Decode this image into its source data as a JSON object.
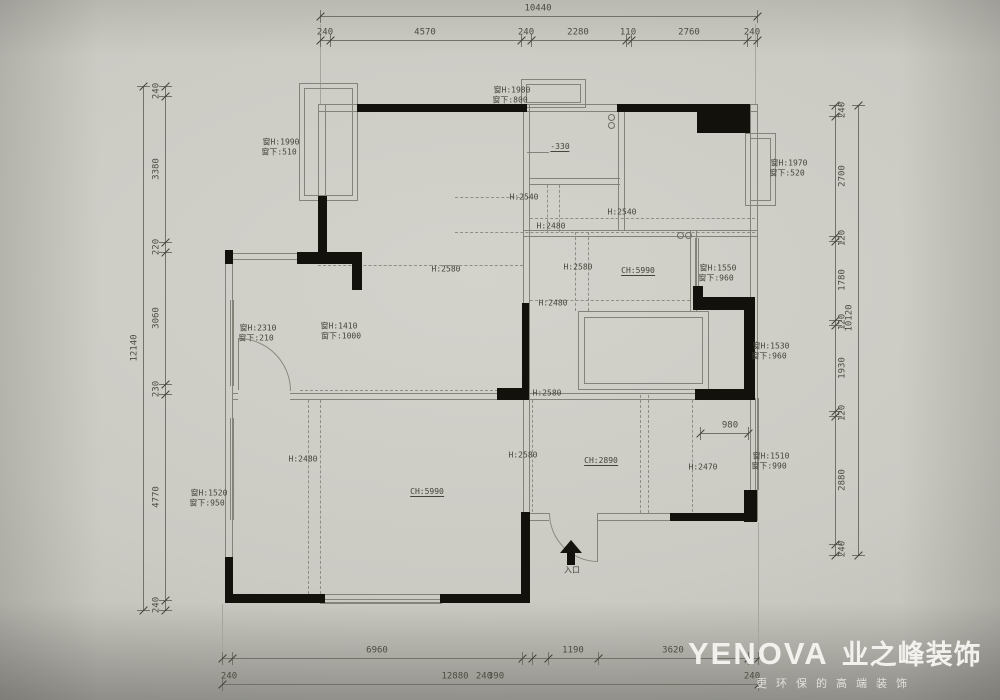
{
  "palette": {
    "background": "#cbcac3",
    "thin_line": "#84837a",
    "black_wall": "#12110c",
    "text": "#45443c",
    "logo_text": "#f2f1ed"
  },
  "dimensions": [
    {
      "id": "top-overall",
      "o": "h",
      "pos": 16,
      "a": 320,
      "b": 757,
      "ticks": [
        320,
        757
      ],
      "labels": [
        {
          "t": "10440",
          "p": 538
        }
      ]
    },
    {
      "id": "top-segments",
      "o": "h",
      "pos": 40,
      "a": 320,
      "b": 757,
      "ticks": [
        320,
        330,
        521,
        531,
        626,
        631,
        747,
        757
      ],
      "labels": [
        {
          "t": "240",
          "p": 325
        },
        {
          "t": "4570",
          "p": 425
        },
        {
          "t": "240",
          "p": 526
        },
        {
          "t": "2280",
          "p": 578
        },
        {
          "t": "110",
          "p": 628
        },
        {
          "t": "2760",
          "p": 689
        },
        {
          "t": "240",
          "p": 752
        }
      ]
    },
    {
      "id": "left-overall",
      "o": "v",
      "pos": 143,
      "a": 86,
      "b": 610,
      "lside": -1,
      "ticks": [
        86,
        610
      ],
      "labels": [
        {
          "t": "12140",
          "p": 348
        }
      ]
    },
    {
      "id": "left-segments",
      "o": "v",
      "pos": 165,
      "a": 86,
      "b": 610,
      "lside": -1,
      "ticks": [
        86,
        96,
        242,
        252,
        384,
        394,
        600,
        610
      ],
      "labels": [
        {
          "t": "240",
          "p": 91
        },
        {
          "t": "3380",
          "p": 169
        },
        {
          "t": "220",
          "p": 247
        },
        {
          "t": "3060",
          "p": 318
        },
        {
          "t": "230",
          "p": 389
        },
        {
          "t": "4770",
          "p": 497
        },
        {
          "t": "240",
          "p": 605
        }
      ]
    },
    {
      "id": "right-segments",
      "o": "v",
      "pos": 835,
      "a": 105,
      "b": 555,
      "lside": 1,
      "ticks": [
        105,
        116,
        236,
        241,
        320,
        325,
        411,
        416,
        544,
        555
      ],
      "labels": [
        {
          "t": "240",
          "p": 110
        },
        {
          "t": "2700",
          "p": 176
        },
        {
          "t": "120",
          "p": 238
        },
        {
          "t": "1780",
          "p": 280
        },
        {
          "t": "120",
          "p": 322
        },
        {
          "t": "1930",
          "p": 368
        },
        {
          "t": "120",
          "p": 413
        },
        {
          "t": "2880",
          "p": 480
        },
        {
          "t": "240",
          "p": 549
        }
      ]
    },
    {
      "id": "right-overall",
      "o": "v",
      "pos": 858,
      "a": 105,
      "b": 555,
      "lside": -1,
      "ticks": [
        105,
        555
      ],
      "labels": [
        {
          "t": "10120",
          "p": 318
        }
      ]
    },
    {
      "id": "bottom-segments",
      "o": "h",
      "pos": 658,
      "a": 222,
      "b": 758,
      "ticks": [
        222,
        232,
        522,
        532,
        548,
        598,
        748,
        758
      ],
      "labels": [
        {
          "t": "6960",
          "p": 377
        },
        {
          "t": "1190",
          "p": 573
        },
        {
          "t": "3620",
          "p": 673
        }
      ]
    },
    {
      "id": "bottom-overall",
      "o": "h",
      "pos": 684,
      "a": 222,
      "b": 758,
      "ticks": [
        222,
        758
      ],
      "labels": [
        {
          "t": "240",
          "p": 229
        },
        {
          "t": "12880",
          "p": 455
        },
        {
          "t": "240",
          "p": 484
        },
        {
          "t": "390",
          "p": 496
        },
        {
          "t": "240",
          "p": 752
        }
      ]
    },
    {
      "id": "dim-980",
      "o": "h",
      "pos": 433,
      "a": 700,
      "b": 748,
      "ticks": [
        700,
        748
      ],
      "labels": [
        {
          "t": "980",
          "p": 730
        }
      ]
    }
  ],
  "annotations": [
    {
      "t": "窗H:1980",
      "x": 512,
      "y": 90
    },
    {
      "t": "窗下:800",
      "x": 510,
      "y": 100
    },
    {
      "t": "窗H:1990",
      "x": 281,
      "y": 142
    },
    {
      "t": "窗下:510",
      "x": 279,
      "y": 152
    },
    {
      "t": "窗H:1970",
      "x": 789,
      "y": 163
    },
    {
      "t": "窗下:520",
      "x": 787,
      "y": 173
    },
    {
      "t": "-330",
      "x": 560,
      "y": 147,
      "ul": true
    },
    {
      "t": "H:2540",
      "x": 524,
      "y": 197
    },
    {
      "t": "H:2540",
      "x": 622,
      "y": 212
    },
    {
      "t": "H:2480",
      "x": 551,
      "y": 226
    },
    {
      "t": "H:2580",
      "x": 446,
      "y": 269
    },
    {
      "t": "H:2580",
      "x": 578,
      "y": 267
    },
    {
      "t": "CH:5990",
      "x": 638,
      "y": 271,
      "ul": true
    },
    {
      "t": "H:2480",
      "x": 553,
      "y": 303
    },
    {
      "t": "窗H:1550",
      "x": 718,
      "y": 268
    },
    {
      "t": "窗下:960",
      "x": 716,
      "y": 278
    },
    {
      "t": "窗H:2310",
      "x": 258,
      "y": 328
    },
    {
      "t": "窗下:210",
      "x": 256,
      "y": 338
    },
    {
      "t": "窗H:1410",
      "x": 339,
      "y": 326
    },
    {
      "t": "窗下:1000",
      "x": 341,
      "y": 336
    },
    {
      "t": "窗H:1530",
      "x": 771,
      "y": 346
    },
    {
      "t": "窗下:960",
      "x": 769,
      "y": 356
    },
    {
      "t": "H:2580",
      "x": 547,
      "y": 393
    },
    {
      "t": "H:2580",
      "x": 523,
      "y": 455
    },
    {
      "t": "CH:2890",
      "x": 601,
      "y": 461,
      "ul": true
    },
    {
      "t": "H:2470",
      "x": 703,
      "y": 467
    },
    {
      "t": "H:2480",
      "x": 303,
      "y": 459
    },
    {
      "t": "窗H:1520",
      "x": 209,
      "y": 493
    },
    {
      "t": "窗下:950",
      "x": 207,
      "y": 503
    },
    {
      "t": "CH:5990",
      "x": 427,
      "y": 492,
      "ul": true
    },
    {
      "t": "窗H:1510",
      "x": 771,
      "y": 456
    },
    {
      "t": "窗下:990",
      "x": 769,
      "y": 466
    },
    {
      "t": "入口",
      "x": 572,
      "y": 570
    }
  ],
  "logo": {
    "brand": "YENOVA",
    "brand_cn": "业之峰装饰",
    "tagline": "更环保的高端装饰"
  }
}
